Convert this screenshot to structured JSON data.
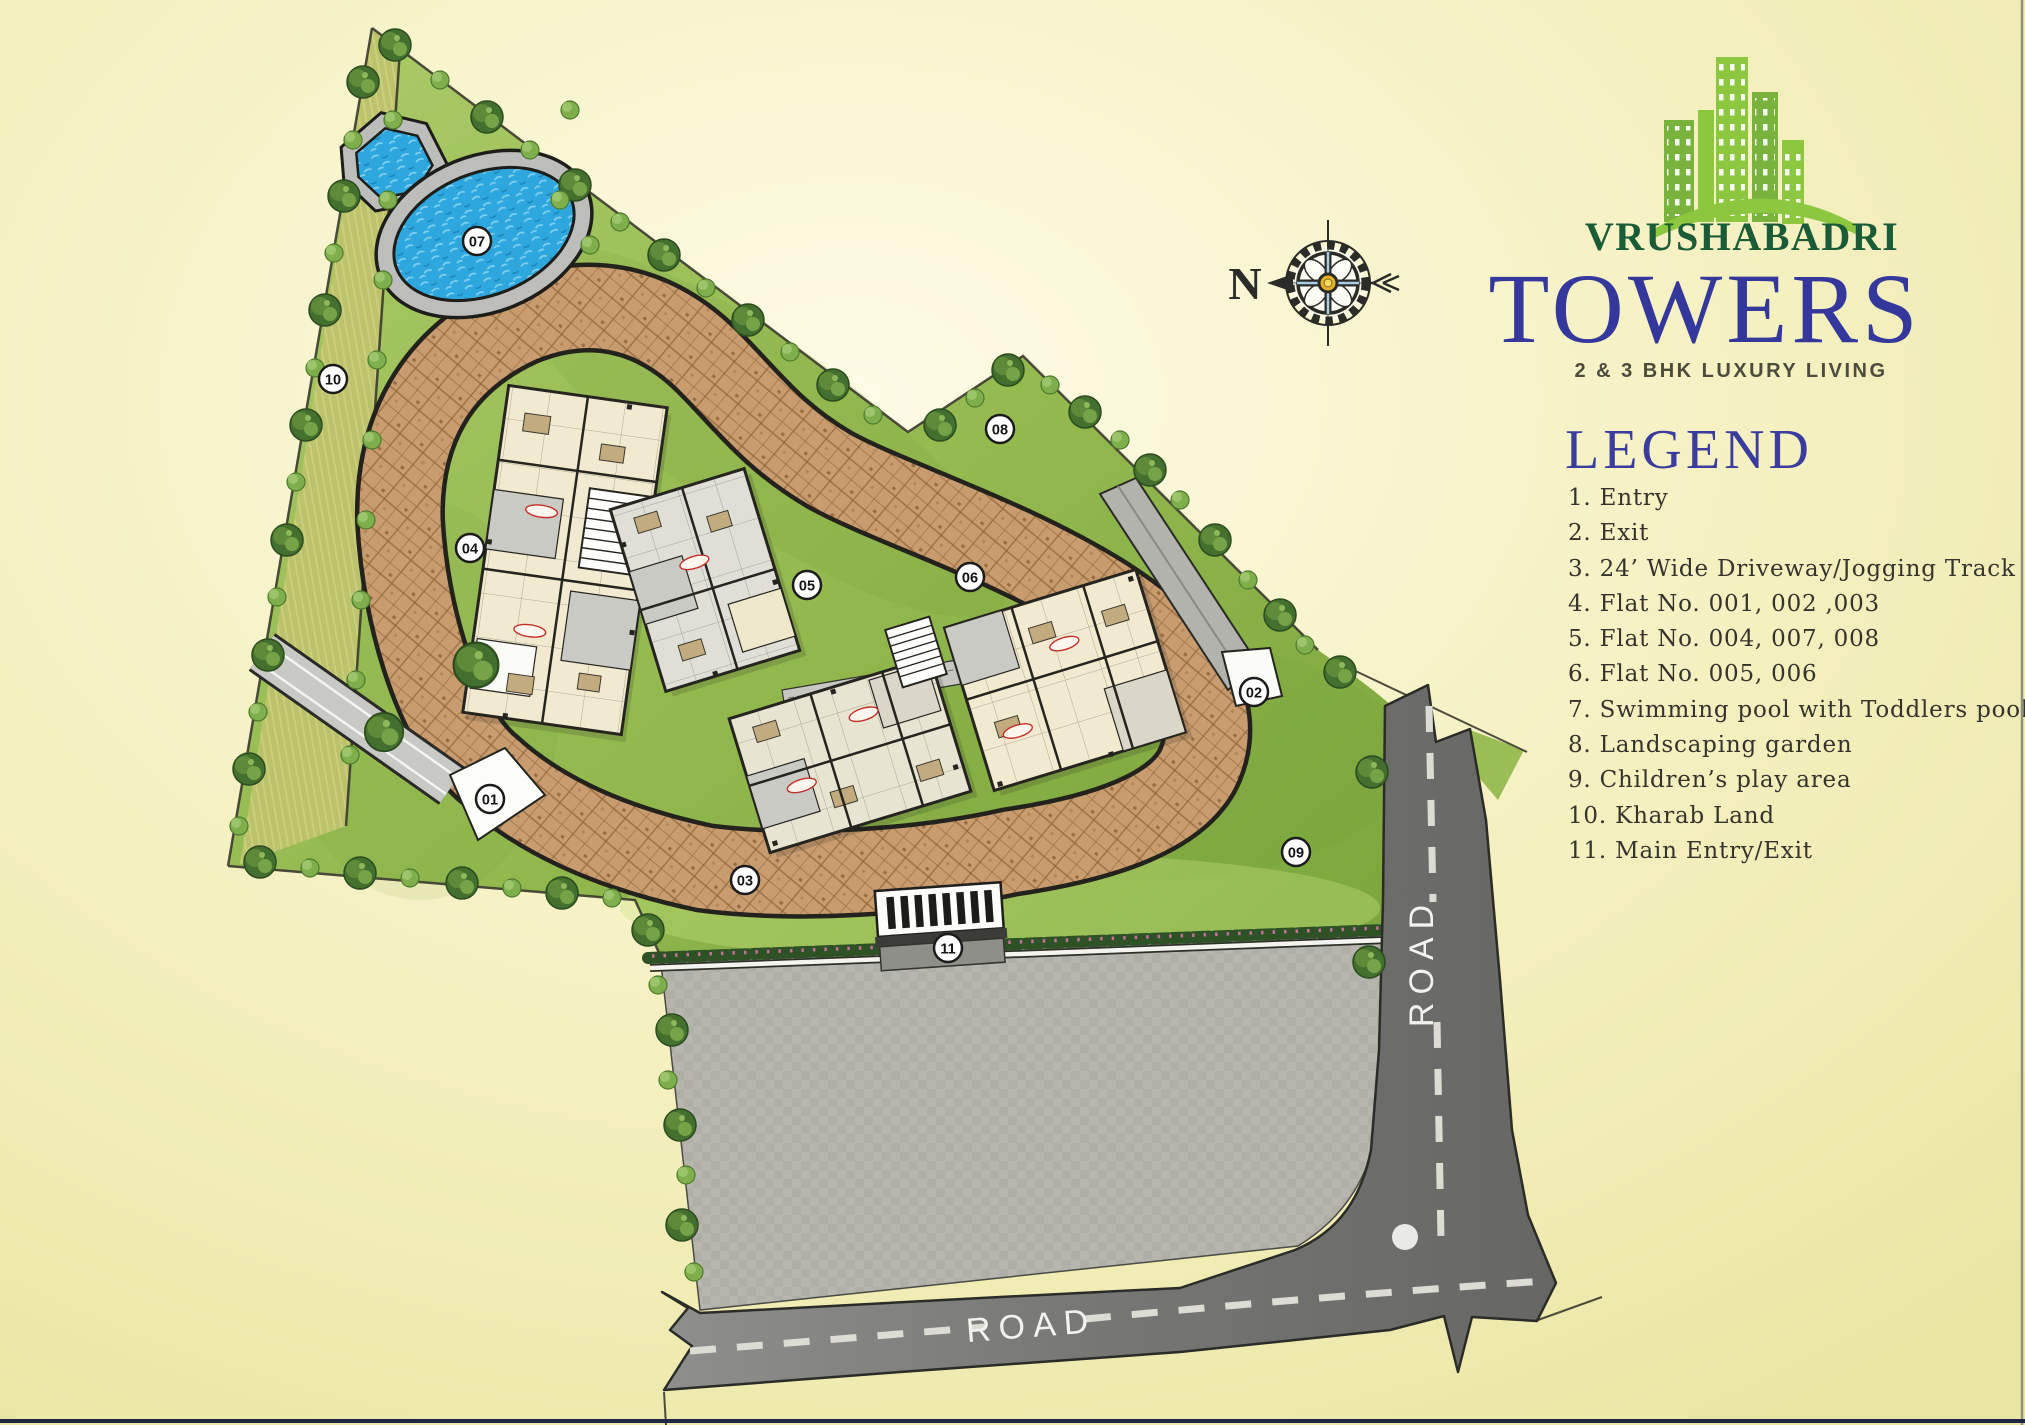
{
  "brand": {
    "logo_icon": "green-towers-skyline-icon",
    "name_top": "VRUSHABADRI",
    "name_main": "TOWERS",
    "tagline": "2 & 3 BHK LUXURY LIVING"
  },
  "compass": {
    "north_label": "N"
  },
  "legend": {
    "title": "LEGEND",
    "items": [
      "1. Entry",
      "2. Exit",
      "3. 24’ Wide Driveway/Jogging Track",
      "4. Flat No. 001, 002 ,003",
      "5. Flat No. 004, 007, 008",
      "6. Flat No. 005, 006",
      "7. Swimming pool with Toddlers pool",
      "8. Landscaping garden",
      "9. Children’s play area",
      "10. Kharab Land",
      "11. Main Entry/Exit"
    ]
  },
  "map": {
    "marker_labels": [
      "01",
      "02",
      "03",
      "04",
      "05",
      "06",
      "07",
      "08",
      "09",
      "10",
      "11"
    ],
    "road_label_vertical": "ROAD",
    "road_label_horizontal": "ROAD"
  },
  "colors": {
    "background": "#F6F2C6",
    "lawn_green": "#8FB449",
    "kharab_olive": "#BEC26C",
    "driveway_brown": "#C89C6F",
    "road_gray": "#7C7C7A",
    "parking_gray": "#B6B6AE",
    "pool_blue": "#2EA7DE",
    "legend_blue": "#3B3D9E",
    "brand_green": "#1A5B38",
    "towers_blue": "#34379B",
    "logo_leaf_green": "#8DC63F",
    "tagline_gray": "#4C4B3C"
  }
}
